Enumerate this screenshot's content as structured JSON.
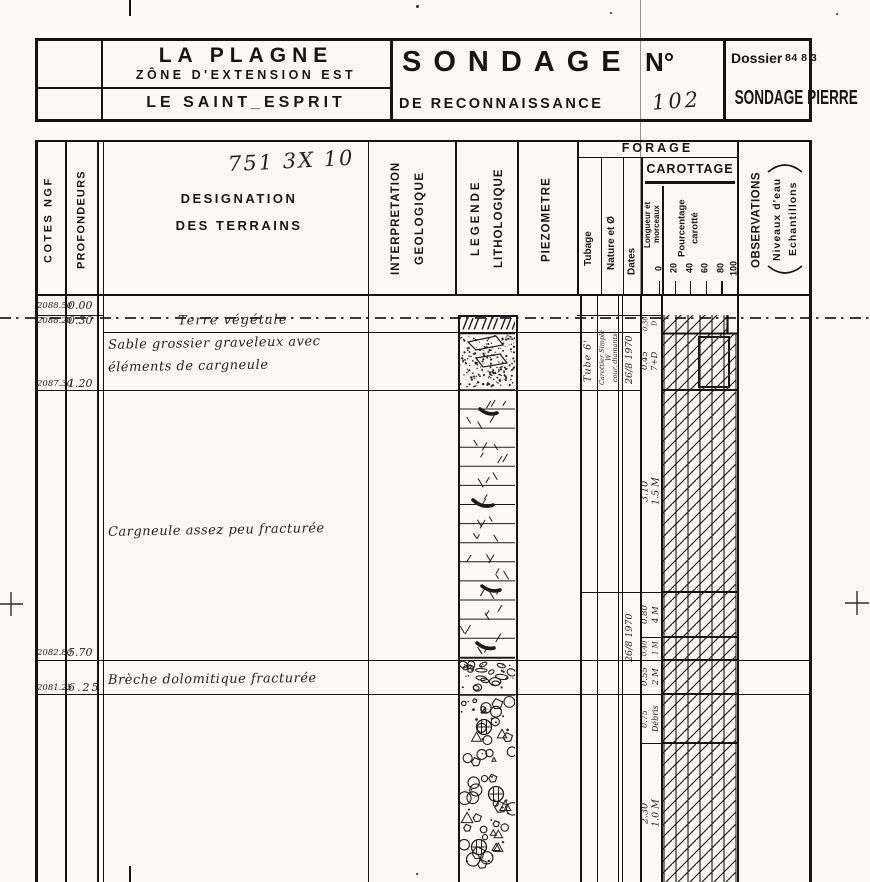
{
  "title_block": {
    "site_line1": "LA PLAGNE",
    "site_line2": "ZÔNE D'EXTENSION EST",
    "site_line3": "LE SAINT_ESPRIT",
    "sondage_word": "SONDAGE",
    "numero_label": "N°",
    "subtitle": "DE RECONNAISSANCE",
    "sondage_number": "102",
    "dossier_label": "Dossier",
    "dossier_number": "84 8 3",
    "stamp": "SONDAGE PIERRE"
  },
  "header": {
    "archive_number": "751 3X 10",
    "cotes": "COTES NGF",
    "profondeurs": "PROFONDEURS",
    "designation_line1": "DESIGNATION",
    "designation_line2": "DES TERRAINS",
    "interpretation_line1": "INTERPRETATION",
    "interpretation_line2": "GEOLOGIQUE",
    "legende_line1": "LEGENDE",
    "legende_line2": "LITHOLOGIQUE",
    "piezometre": "PIEZOMETRE",
    "forage": "FORAGE",
    "tubage": "Tubage",
    "nature": "Nature et Ø",
    "dates": "Dates",
    "carottage": "CAROTTAGE",
    "longueur_line1": "Longueur et",
    "longueur_line2": "morceaux",
    "pourcentage_line1": "Pourcentage",
    "pourcentage_line2": "carotté",
    "scale": [
      "0",
      "20",
      "40",
      "60",
      "80",
      "100"
    ],
    "observations": "OBSERVATIONS",
    "observations_line1": "Niveaux d'eau",
    "observations_line2": "Echantillons"
  },
  "log": {
    "depth_marks": [
      {
        "cote": "2088.50",
        "depth": "0.00"
      },
      {
        "cote": "2088.20",
        "depth": "0.30"
      },
      {
        "cote": "2087.30",
        "depth": "1.20"
      },
      {
        "cote": "2082.80",
        "depth": "5.70"
      },
      {
        "cote": "2081.25",
        "depth": "6.25"
      }
    ],
    "terrains": [
      {
        "lines": [
          "Terre végétale"
        ]
      },
      {
        "lines": [
          "Sable grossier graveleux avec",
          "éléments de cargneule"
        ]
      },
      {
        "lines": [
          "Cargneule assez peu fracturée"
        ]
      },
      {
        "lines": [
          "Brèche dolomitique fracturée"
        ]
      }
    ],
    "forage_notes": {
      "tubage": "Tube 6'",
      "nature_lines": [
        "Carottier Simple",
        "W",
        "cour. diamants"
      ],
      "date_run1": "26/8 1970",
      "date_run2": "26/8 1970"
    },
    "carottage_runs": [
      {
        "longueur": "0.30",
        "morceaux": "D"
      },
      {
        "longueur": "0.45",
        "morceaux": "7+D"
      },
      {
        "longueur": "3.10",
        "morceaux": "1.5 M"
      },
      {
        "longueur": "0.80",
        "morceaux": "4 M"
      },
      {
        "longueur": "0.40",
        "morceaux": "1 M"
      },
      {
        "longueur": "0.55",
        "morceaux": "2 M"
      },
      {
        "longueur": "0.75",
        "morceaux": "Débris"
      },
      {
        "longueur": "2.30",
        "morceaux": "1.0 M"
      }
    ]
  }
}
